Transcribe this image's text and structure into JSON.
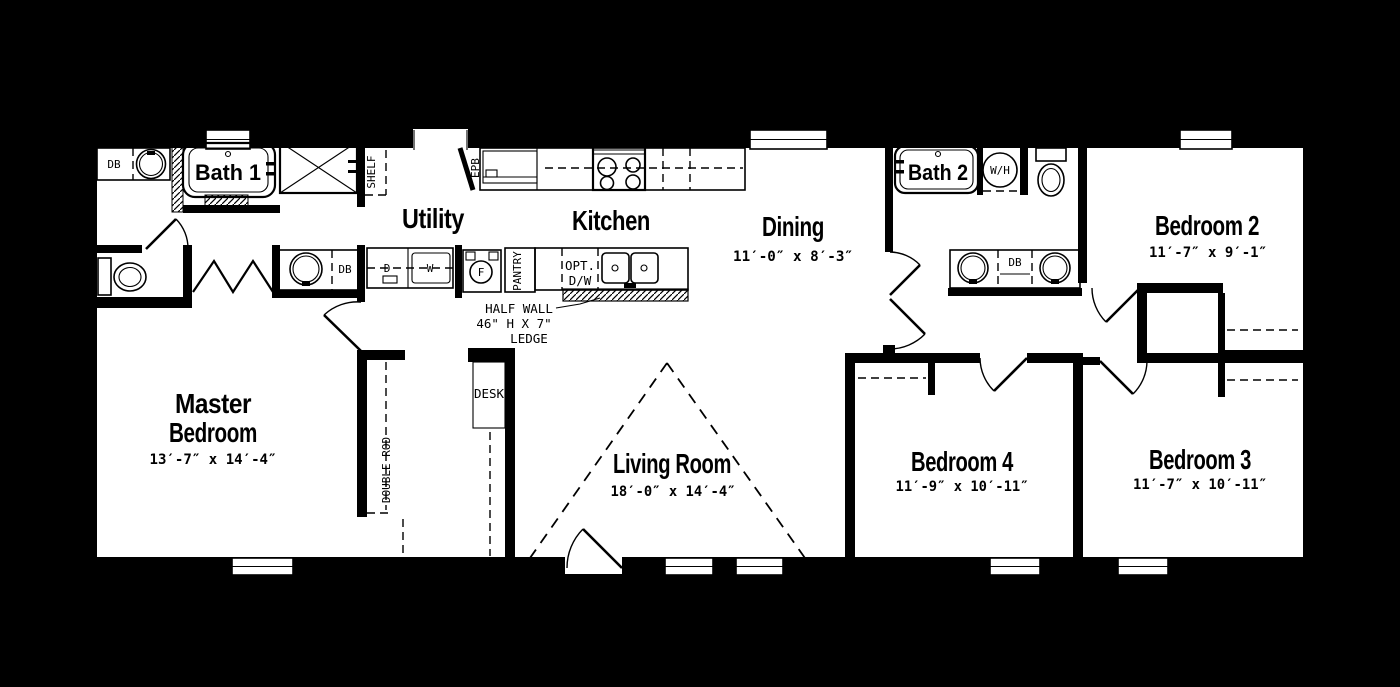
{
  "colors": {
    "background": "#000000",
    "floor": "#ffffff",
    "line": "#000000"
  },
  "rooms": {
    "master_bedroom": {
      "name_line1": "Master",
      "name_line2": "Bedroom",
      "dims": "13′-7″ x 14′-4″"
    },
    "living_room": {
      "name": "Living Room",
      "dims": "18′-0″ x 14′-4″"
    },
    "dining": {
      "name": "Dining",
      "dims": "11′-0″ x 8′-3″"
    },
    "kitchen": {
      "name": "Kitchen"
    },
    "utility": {
      "name": "Utility"
    },
    "bath1": {
      "name": "Bath 1"
    },
    "bath2": {
      "name": "Bath 2"
    },
    "bedroom2": {
      "name": "Bedroom 2",
      "dims": "11′-7″ x 9′-1″"
    },
    "bedroom3": {
      "name": "Bedroom 3",
      "dims": "11′-7″ x 10′-11″"
    },
    "bedroom4": {
      "name": "Bedroom 4",
      "dims": "11′-9″ x 10′-11″"
    }
  },
  "annotations": {
    "half_wall_line1": "HALF WALL",
    "half_wall_line2": "46\" H X 7\"",
    "half_wall_line3": "LEDGE",
    "desk": "DESK",
    "double_rod": "DOUBLE ROD",
    "shelf": "SHELF",
    "pantry": "PANTRY",
    "epb": "EPB",
    "opt_dw_line1": "OPT.",
    "opt_dw_line2": "D/W"
  },
  "fixtures": {
    "db": "DB",
    "dryer": "D",
    "washer": "W",
    "fridge": "F",
    "water_heater": "W/H"
  }
}
